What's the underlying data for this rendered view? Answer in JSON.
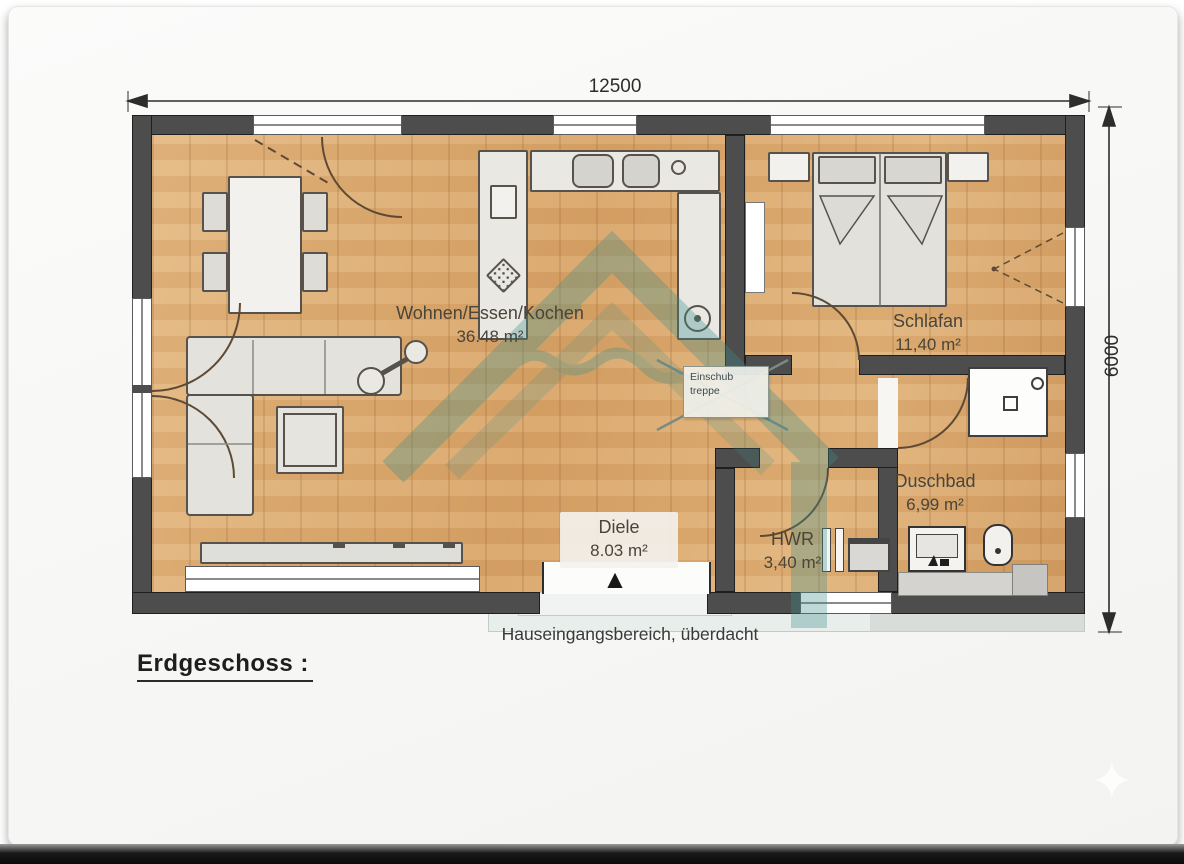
{
  "document": {
    "floor_label": "Erdgeschoss :",
    "entrance_note": "Hauseingangsbereich, überdacht"
  },
  "dimensions": {
    "total_width_mm": "12500",
    "total_depth_mm": "6000"
  },
  "rooms": {
    "living_kitchen": {
      "name": "Wohnen/Essen/Kochen",
      "area": "36.48 m²"
    },
    "bedroom": {
      "name": "Schlafan",
      "area": "11,40 m²"
    },
    "hallway": {
      "name": "Diele",
      "area": "8.03 m²"
    },
    "utility": {
      "name": "HWR",
      "area": "3,40 m²"
    },
    "bathroom": {
      "name": "Duschbad",
      "area": "6,99 m²"
    }
  },
  "attic_stair_label": {
    "line1": "Einschub",
    "line2": "treppe"
  },
  "icons": {
    "entrance_arrow": "▲",
    "sparkle": "✦"
  },
  "colors": {
    "exterior_wall": "#4d4d4d",
    "wood_floor": "#d9a76c",
    "watermark_teal": "#3d8f8c",
    "furniture_fill": "#e9e8e3",
    "paper": "#f9f9f8"
  }
}
